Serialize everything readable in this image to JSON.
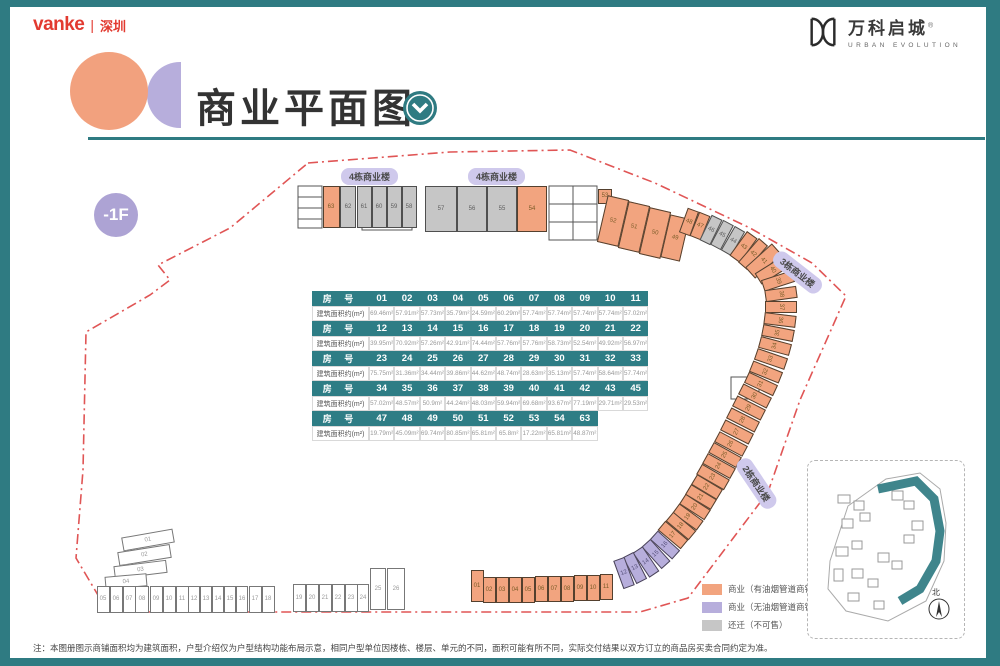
{
  "header": {
    "vanke": "vanke",
    "divider": "|",
    "city": "深圳",
    "project": "万科启城",
    "project_mark": "®",
    "project_en": "URBAN EVOLUTION"
  },
  "title": "商业平面图",
  "floor": "-1F",
  "labels": {
    "b4a": "4栋商业楼",
    "b4b": "4栋商业楼",
    "b3": "3栋商业楼",
    "b2": "2栋商业楼"
  },
  "table": {
    "room_header": "房 号",
    "area_header": "建筑面积约(m²)",
    "rows": [
      {
        "nums": [
          "01",
          "02",
          "03",
          "04",
          "05",
          "06",
          "07",
          "08",
          "09",
          "10",
          "11"
        ],
        "areas": [
          "69.46m²",
          "57.91m²",
          "57.73m²",
          "35.79m²",
          "24.59m²",
          "60.29m²",
          "57.74m²",
          "57.74m²",
          "57.74m²",
          "57.74m²",
          "57.02m²"
        ]
      },
      {
        "nums": [
          "12",
          "13",
          "14",
          "15",
          "16",
          "17",
          "18",
          "19",
          "20",
          "21",
          "22"
        ],
        "areas": [
          "39.95m²",
          "70.92m²",
          "57.26m²",
          "42.91m²",
          "74.44m²",
          "57.76m²",
          "57.76m²",
          "58.73m²",
          "52.54m²",
          "49.92m²",
          "56.97m²"
        ]
      },
      {
        "nums": [
          "23",
          "24",
          "25",
          "26",
          "27",
          "28",
          "29",
          "30",
          "31",
          "32",
          "33"
        ],
        "areas": [
          "75.75m²",
          "31.36m²",
          "34.44m²",
          "39.86m²",
          "44.62m²",
          "48.74m²",
          "28.63m²",
          "35.13m²",
          "57.74m²",
          "58.64m²",
          "57.74m²"
        ]
      },
      {
        "nums": [
          "34",
          "35",
          "36",
          "37",
          "38",
          "39",
          "40",
          "41",
          "42",
          "43",
          "45"
        ],
        "areas": [
          "57.02m²",
          "48.57m²",
          "50.9m²",
          "44.24m²",
          "48.03m²",
          "59.94m²",
          "69.68m²",
          "93.67m²",
          "77.19m²",
          "29.71m²",
          "29.53m²"
        ]
      },
      {
        "nums": [
          "47",
          "48",
          "49",
          "50",
          "51",
          "52",
          "53",
          "54",
          "63"
        ],
        "areas": [
          "19.79m²",
          "45.09m²",
          "69.74m²",
          "80.85m²",
          "65.81m²",
          "65.8m²",
          "17.22m²",
          "65.81m²",
          "48.87m²"
        ]
      }
    ]
  },
  "legend": {
    "items": [
      {
        "label": "商业（有油烟管道商铺）",
        "color": "#F2A47F"
      },
      {
        "label": "商业（无油烟管道商铺）",
        "color": "#B7AEDC"
      },
      {
        "label": "还迁（不可售）",
        "color": "#C6C6C6"
      }
    ]
  },
  "minimap": {
    "compass": "北"
  },
  "note": "注：本图册图示商铺面积均为建筑面积，户型介绍仅为户型结构功能布局示意，相同户型单位因楼栋、楼层、单元的不同，面积可能有所不同，实际交付结果以双方订立的商品房买卖合同约定为准。",
  "units": [
    [
      "63",
      331,
      207,
      17,
      42,
      0,
      "o"
    ],
    [
      "62",
      348,
      207,
      16,
      42,
      0,
      "g"
    ],
    [
      "61",
      364,
      207,
      15,
      42,
      0,
      "g"
    ],
    [
      "60",
      379,
      207,
      15,
      42,
      0,
      "g"
    ],
    [
      "59",
      394,
      207,
      15,
      42,
      0,
      "g"
    ],
    [
      "58",
      409,
      207,
      15,
      42,
      0,
      "g"
    ],
    [
      "57",
      441,
      209,
      32,
      46,
      0,
      "g"
    ],
    [
      "56",
      472,
      209,
      30,
      46,
      0,
      "g"
    ],
    [
      "55",
      502,
      209,
      30,
      46,
      0,
      "g"
    ],
    [
      "54",
      532,
      209,
      30,
      46,
      0,
      "o"
    ],
    [
      "53",
      605,
      196,
      14,
      15,
      0,
      "o"
    ],
    [
      "52",
      613,
      221,
      22,
      48,
      13,
      "o"
    ],
    [
      "51",
      634,
      227,
      22,
      48,
      13,
      "o"
    ],
    [
      "50",
      655,
      233,
      22,
      48,
      13,
      "o"
    ],
    [
      "49",
      675,
      238,
      20,
      44,
      13,
      "o"
    ],
    [
      "48",
      689,
      222,
      12,
      26,
      20,
      "o"
    ],
    [
      "47",
      700,
      226,
      12,
      26,
      22,
      "o"
    ],
    [
      "46",
      711,
      230,
      12,
      28,
      26,
      "g"
    ],
    [
      "45",
      722,
      235,
      12,
      28,
      28,
      "g"
    ],
    [
      "44",
      733,
      241,
      12,
      28,
      30,
      "g"
    ],
    [
      "43",
      743,
      247,
      13,
      30,
      36,
      "o"
    ],
    [
      "42",
      753,
      254,
      12,
      32,
      41,
      "o"
    ],
    [
      "41",
      763,
      261,
      15,
      36,
      48,
      "o"
    ],
    [
      "40",
      772,
      270,
      13,
      34,
      58,
      "o"
    ],
    [
      "39",
      778,
      281,
      12,
      32,
      72,
      "o"
    ],
    [
      "38",
      781,
      294,
      12,
      32,
      82,
      "o"
    ],
    [
      "37",
      781,
      307,
      12,
      32,
      90,
      "o"
    ],
    [
      "36",
      780,
      320,
      12,
      32,
      97,
      "o"
    ],
    [
      "35",
      778,
      333,
      12,
      32,
      -79,
      "o"
    ],
    [
      "34",
      775,
      346,
      12,
      32,
      -75,
      "o"
    ],
    [
      "33",
      771,
      359,
      12,
      32,
      -71,
      "o"
    ],
    [
      "32",
      766,
      372,
      12,
      32,
      -68,
      "o"
    ],
    [
      "31",
      761,
      384,
      12,
      32,
      -65,
      "o"
    ],
    [
      "30",
      755,
      396,
      12,
      32,
      -63,
      "o"
    ],
    [
      "29",
      749,
      408,
      12,
      32,
      -63,
      "o"
    ],
    [
      "28",
      743,
      420,
      12,
      32,
      -63,
      "o"
    ],
    [
      "27",
      737,
      432,
      12,
      32,
      -63,
      "o"
    ],
    [
      "26",
      731,
      444,
      12,
      32,
      -62,
      "o"
    ],
    [
      "25",
      725,
      455,
      12,
      32,
      -61,
      "o"
    ],
    [
      "24",
      719,
      466,
      12,
      32,
      -61,
      "o"
    ],
    [
      "23",
      713,
      477,
      12,
      32,
      -60,
      "o"
    ],
    [
      "22",
      707,
      487,
      12,
      30,
      -59,
      "o"
    ],
    [
      "21",
      701,
      497,
      12,
      30,
      -59,
      "o"
    ],
    [
      "20",
      695,
      507,
      12,
      30,
      -57,
      "o"
    ],
    [
      "19",
      688,
      517,
      12,
      30,
      -54,
      "o"
    ],
    [
      "18",
      681,
      526,
      12,
      30,
      -50,
      "o"
    ],
    [
      "17",
      673,
      535,
      12,
      30,
      -50,
      "o"
    ],
    [
      "16",
      665,
      545,
      12,
      30,
      -48,
      "p"
    ],
    [
      "15",
      656,
      554,
      12,
      30,
      -42,
      "p"
    ],
    [
      "14",
      646,
      562,
      12,
      30,
      -34,
      "p"
    ],
    [
      "13",
      635,
      568,
      12,
      30,
      -27,
      "p"
    ],
    [
      "12",
      624,
      573,
      12,
      30,
      -20,
      "p"
    ],
    [
      "11",
      606,
      587,
      13,
      26,
      0,
      "o"
    ],
    [
      "10",
      593,
      588,
      13,
      26,
      0,
      "o"
    ],
    [
      "09",
      580,
      588,
      13,
      26,
      0,
      "o"
    ],
    [
      "08",
      567,
      589,
      13,
      26,
      0,
      "o"
    ],
    [
      "07",
      554,
      589,
      13,
      26,
      0,
      "o"
    ],
    [
      "06",
      541,
      589,
      13,
      26,
      0,
      "o"
    ],
    [
      "05",
      528,
      590,
      13,
      26,
      0,
      "o"
    ],
    [
      "04",
      515,
      590,
      13,
      26,
      0,
      "o"
    ],
    [
      "03",
      502,
      590,
      13,
      26,
      0,
      "o"
    ],
    [
      "02",
      489,
      590,
      13,
      26,
      0,
      "o"
    ],
    [
      "01",
      477,
      586,
      13,
      32,
      0,
      "o"
    ],
    [
      "01",
      148,
      540,
      52,
      14,
      -10,
      "w"
    ],
    [
      "02",
      144,
      555,
      53,
      14,
      -9,
      "w"
    ],
    [
      "03",
      140,
      569,
      53,
      13,
      -7,
      "w"
    ],
    [
      "04",
      126,
      581,
      42,
      13,
      -5,
      "w"
    ],
    [
      "05",
      103,
      599,
      13,
      27,
      0,
      "w"
    ],
    [
      "06",
      116,
      599,
      13,
      27,
      0,
      "w"
    ],
    [
      "07",
      129,
      599,
      13,
      27,
      0,
      "w"
    ],
    [
      "08",
      142,
      599,
      14,
      27,
      0,
      "w"
    ],
    [
      "09",
      156,
      599,
      13,
      27,
      0,
      "w"
    ],
    [
      "10",
      169,
      599,
      13,
      27,
      0,
      "w"
    ],
    [
      "11",
      182,
      599,
      13,
      27,
      0,
      "w"
    ],
    [
      "12",
      194,
      599,
      12,
      27,
      0,
      "w"
    ],
    [
      "13",
      206,
      599,
      12,
      27,
      0,
      "w"
    ],
    [
      "14",
      218,
      599,
      12,
      27,
      0,
      "w"
    ],
    [
      "15",
      230,
      599,
      12,
      27,
      0,
      "w"
    ],
    [
      "16",
      242,
      599,
      12,
      27,
      0,
      "w"
    ],
    [
      "17",
      255,
      599,
      13,
      27,
      0,
      "w"
    ],
    [
      "18",
      268,
      599,
      13,
      27,
      0,
      "w"
    ],
    [
      "19",
      299,
      598,
      13,
      28,
      0,
      "w"
    ],
    [
      "20",
      312,
      598,
      13,
      28,
      0,
      "w"
    ],
    [
      "21",
      325,
      598,
      13,
      28,
      0,
      "w"
    ],
    [
      "22",
      338,
      598,
      13,
      28,
      0,
      "w"
    ],
    [
      "23",
      351,
      598,
      13,
      28,
      0,
      "w"
    ],
    [
      "24",
      363,
      598,
      12,
      28,
      0,
      "w"
    ],
    [
      "25",
      378,
      589,
      16,
      42,
      0,
      "w"
    ],
    [
      "26",
      396,
      589,
      18,
      42,
      0,
      "w"
    ]
  ]
}
